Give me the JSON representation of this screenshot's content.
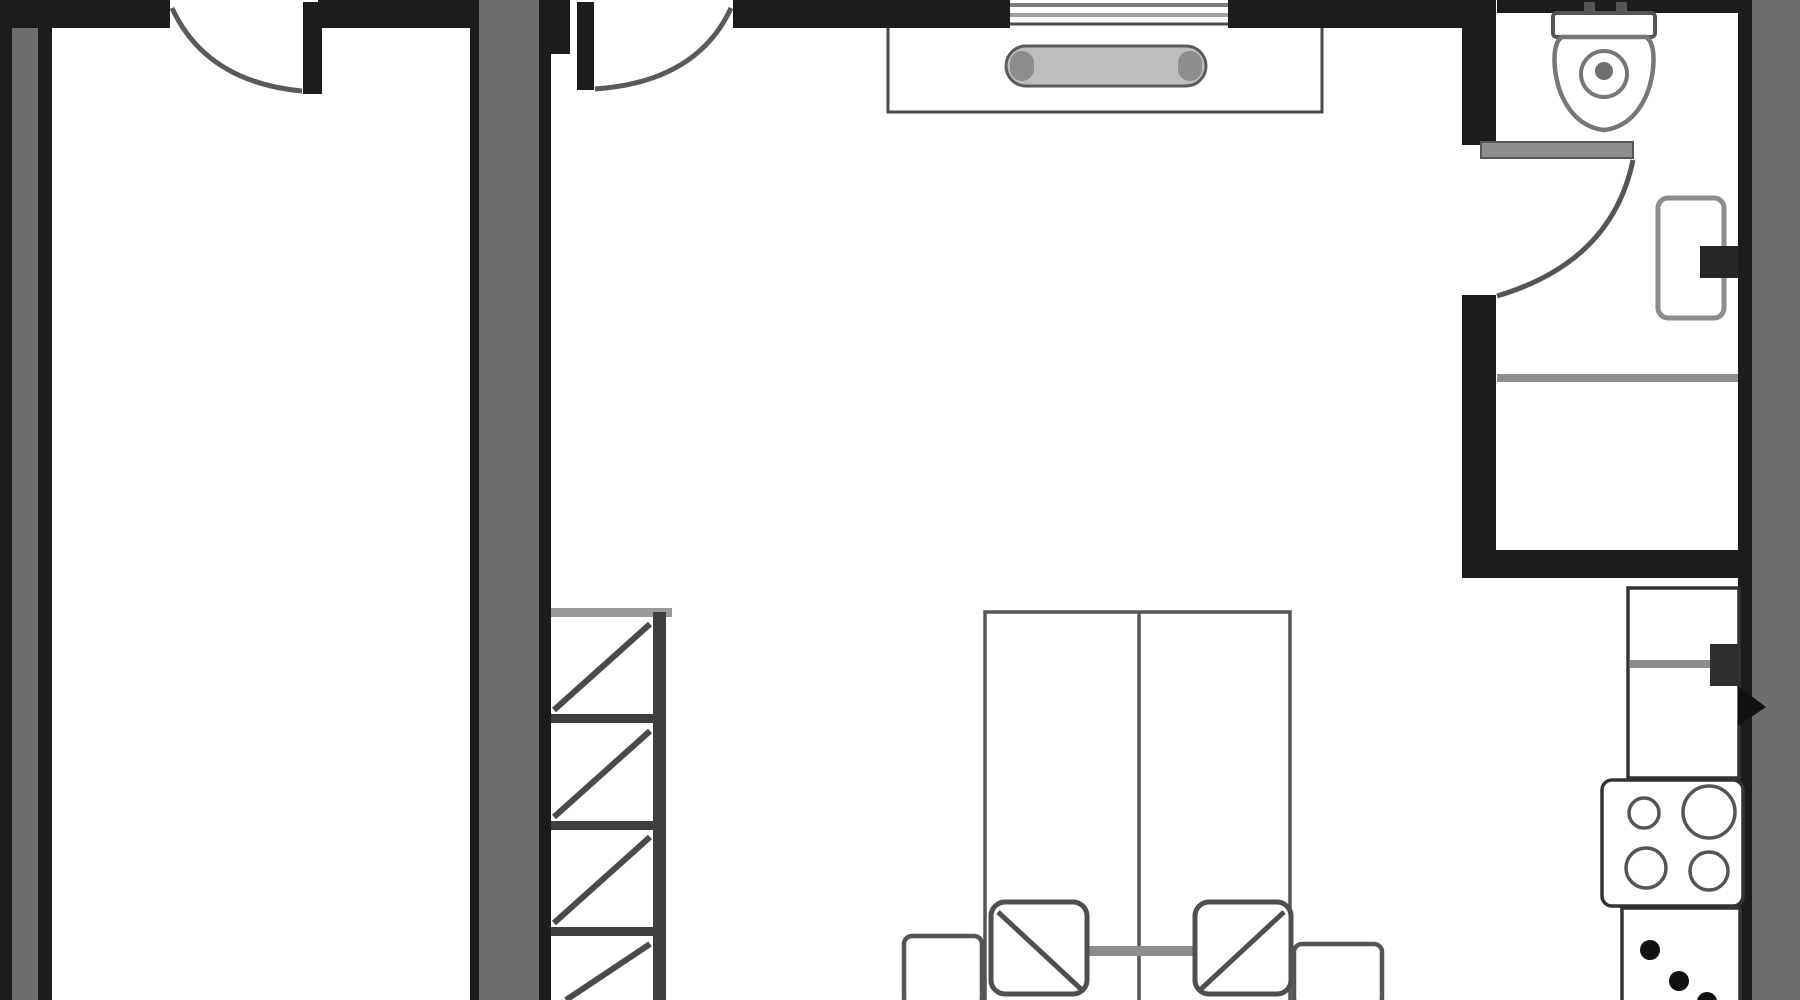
{
  "plan": {
    "canvas": {
      "width": 1800,
      "height": 1000,
      "background": "#ffffff"
    },
    "colors": {
      "wall_dark": "#1c1c1c",
      "wall_fill": "#6e6e6e",
      "outline_dark": "#333333",
      "outline_mid": "#555555",
      "outline_soft": "#7a7a7a",
      "fixture_gray": "#8d8d8d",
      "accent_black": "#111111",
      "floor_white": "#ffffff"
    },
    "shapes": [
      {
        "name": "dresser-body",
        "type": "rect",
        "x": 888,
        "y": 24,
        "w": 434,
        "h": 88,
        "fill": "#ffffff",
        "stroke": "#4a4a4a",
        "sw": 3
      },
      {
        "name": "dresser-handle",
        "type": "rect",
        "x": 1006,
        "y": 46,
        "w": 200,
        "h": 40,
        "rx": 20,
        "fill": "#bdbdbd",
        "stroke": "#5a5a5a",
        "sw": 3
      },
      {
        "name": "dresser-handle-cap-left",
        "type": "rect",
        "x": 1010,
        "y": 51,
        "w": 24,
        "h": 30,
        "rx": 12,
        "fill": "#8d8d8d"
      },
      {
        "name": "dresser-handle-cap-right",
        "type": "rect",
        "x": 1178,
        "y": 51,
        "w": 24,
        "h": 30,
        "rx": 12,
        "fill": "#8d8d8d"
      },
      {
        "name": "stairs-top-edge",
        "type": "rect",
        "x": 550,
        "y": 608,
        "w": 122,
        "h": 9,
        "fill": "#9a9a9a"
      },
      {
        "name": "stairs-tread-1",
        "type": "rect",
        "x": 550,
        "y": 714,
        "w": 106,
        "h": 9,
        "fill": "#3f3f3f"
      },
      {
        "name": "stairs-tread-2",
        "type": "rect",
        "x": 550,
        "y": 821,
        "w": 106,
        "h": 9,
        "fill": "#3f3f3f"
      },
      {
        "name": "stairs-tread-3",
        "type": "rect",
        "x": 550,
        "y": 927,
        "w": 106,
        "h": 9,
        "fill": "#3f3f3f"
      },
      {
        "name": "stairs-rail",
        "type": "rect",
        "x": 653,
        "y": 612,
        "w": 13,
        "h": 388,
        "fill": "#3f3f3f"
      },
      {
        "name": "stairs-diagonal-1",
        "type": "line",
        "x1": 554,
        "y1": 710,
        "x2": 650,
        "y2": 624,
        "stroke": "#4a4a4a",
        "sw": 6
      },
      {
        "name": "stairs-diagonal-2",
        "type": "line",
        "x1": 554,
        "y1": 817,
        "x2": 650,
        "y2": 731,
        "stroke": "#4a4a4a",
        "sw": 6
      },
      {
        "name": "stairs-diagonal-3",
        "type": "line",
        "x1": 554,
        "y1": 923,
        "x2": 650,
        "y2": 837,
        "stroke": "#4a4a4a",
        "sw": 6
      },
      {
        "name": "stairs-diagonal-4",
        "type": "line",
        "x1": 566,
        "y1": 1000,
        "x2": 650,
        "y2": 944,
        "stroke": "#4a4a4a",
        "sw": 6
      },
      {
        "name": "bed-frame",
        "type": "rect",
        "x": 985,
        "y": 612,
        "w": 305,
        "h": 392,
        "fill": "#ffffff",
        "stroke": "#565656",
        "sw": 3.5
      },
      {
        "name": "bed-center-line",
        "type": "line",
        "x1": 1139,
        "y1": 612,
        "x2": 1139,
        "y2": 1000,
        "stroke": "#565656",
        "sw": 3.5
      },
      {
        "name": "bed-blanket-band",
        "type": "rect",
        "x": 1085,
        "y": 946,
        "w": 113,
        "h": 10,
        "fill": "#8d8d8d"
      },
      {
        "name": "bed-blanket-flap-left",
        "type": "rect",
        "x": 991,
        "y": 902,
        "w": 96,
        "h": 92,
        "rx": 14,
        "fill": "#ffffff",
        "stroke": "#4f4f4f",
        "sw": 5
      },
      {
        "name": "bed-blanket-flap-left-fold",
        "type": "line",
        "x1": 998,
        "y1": 912,
        "x2": 1082,
        "y2": 990,
        "stroke": "#4f4f4f",
        "sw": 5
      },
      {
        "name": "bed-blanket-flap-right",
        "type": "rect",
        "x": 1195,
        "y": 902,
        "w": 96,
        "h": 92,
        "rx": 14,
        "fill": "#ffffff",
        "stroke": "#4f4f4f",
        "sw": 5
      },
      {
        "name": "bed-blanket-flap-right-fold",
        "type": "line",
        "x1": 1284,
        "y1": 912,
        "x2": 1200,
        "y2": 990,
        "stroke": "#4f4f4f",
        "sw": 5
      },
      {
        "name": "nightstand-left",
        "type": "rect",
        "x": 904,
        "y": 936,
        "w": 78,
        "h": 70,
        "rx": 8,
        "fill": "#ffffff",
        "stroke": "#555555",
        "sw": 4.5
      },
      {
        "name": "nightstand-right",
        "type": "rect",
        "x": 1294,
        "y": 944,
        "w": 88,
        "h": 62,
        "rx": 8,
        "fill": "#ffffff",
        "stroke": "#555555",
        "sw": 4.5
      },
      {
        "name": "left-wall-outer-edge",
        "type": "rect",
        "x": 0,
        "y": 0,
        "w": 12,
        "h": 1000,
        "fill": "#1c1c1c"
      },
      {
        "name": "left-wall-fill",
        "type": "rect",
        "x": 12,
        "y": 0,
        "w": 26,
        "h": 1000,
        "fill": "#6e6e6e"
      },
      {
        "name": "left-wall-inner-edge",
        "type": "rect",
        "x": 38,
        "y": 0,
        "w": 14,
        "h": 1000,
        "fill": "#1c1c1c"
      },
      {
        "name": "top-wall-segment-1",
        "type": "rect",
        "x": 0,
        "y": 0,
        "w": 170,
        "h": 28,
        "fill": "#1c1c1c"
      },
      {
        "name": "top-wall-segment-2",
        "type": "rect",
        "x": 318,
        "y": 0,
        "w": 152,
        "h": 28,
        "fill": "#1c1c1c"
      },
      {
        "name": "center-wall-left-edge",
        "type": "rect",
        "x": 470,
        "y": 0,
        "w": 9,
        "h": 1000,
        "fill": "#1c1c1c"
      },
      {
        "name": "center-wall-fill",
        "type": "rect",
        "x": 479,
        "y": 0,
        "w": 60,
        "h": 1000,
        "fill": "#6e6e6e"
      },
      {
        "name": "center-wall-right-edge",
        "type": "rect",
        "x": 539,
        "y": 0,
        "w": 12,
        "h": 1000,
        "fill": "#1c1c1c"
      },
      {
        "name": "center-door-jamb",
        "type": "rect",
        "x": 551,
        "y": 0,
        "w": 19,
        "h": 54,
        "fill": "#1c1c1c"
      },
      {
        "name": "top-wall-segment-3",
        "type": "rect",
        "x": 733,
        "y": 0,
        "w": 277,
        "h": 28,
        "fill": "#1c1c1c"
      },
      {
        "name": "top-wall-segment-4",
        "type": "rect",
        "x": 1228,
        "y": 0,
        "w": 234,
        "h": 28,
        "fill": "#1c1c1c"
      },
      {
        "name": "bathroom-top-wall",
        "type": "rect",
        "x": 1497,
        "y": 0,
        "w": 303,
        "h": 13,
        "fill": "#1c1c1c"
      },
      {
        "name": "bathroom-wall-upper-left",
        "type": "rect",
        "x": 1462,
        "y": 0,
        "w": 34,
        "h": 145,
        "fill": "#1c1c1c"
      },
      {
        "name": "bathroom-wall-lower-left",
        "type": "rect",
        "x": 1462,
        "y": 295,
        "w": 34,
        "h": 283,
        "fill": "#1c1c1c"
      },
      {
        "name": "bathroom-bottom-wall",
        "type": "rect",
        "x": 1462,
        "y": 550,
        "w": 276,
        "h": 28,
        "fill": "#1c1c1c"
      },
      {
        "name": "right-wall-inner-edge",
        "type": "rect",
        "x": 1738,
        "y": 0,
        "w": 14,
        "h": 1000,
        "fill": "#1c1c1c"
      },
      {
        "name": "right-wall-fill",
        "type": "rect",
        "x": 1752,
        "y": 0,
        "w": 48,
        "h": 1000,
        "fill": "#6e6e6e"
      },
      {
        "name": "window-outer-line",
        "type": "rect",
        "x": 1010,
        "y": 3,
        "w": 218,
        "h": 4,
        "fill": "#7a7a7a"
      },
      {
        "name": "window-inner-line",
        "type": "rect",
        "x": 1010,
        "y": 13,
        "w": 218,
        "h": 4,
        "fill": "#9f9f9f"
      },
      {
        "name": "toilet-tank",
        "type": "rect",
        "x": 1553,
        "y": 13,
        "w": 102,
        "h": 24,
        "rx": 4,
        "fill": "#ffffff",
        "stroke": "#555555",
        "sw": 4
      },
      {
        "name": "toilet-hinge-left",
        "type": "rect",
        "x": 1584,
        "y": 2,
        "w": 11,
        "h": 11,
        "fill": "#555555"
      },
      {
        "name": "toilet-hinge-right",
        "type": "rect",
        "x": 1616,
        "y": 2,
        "w": 11,
        "h": 11,
        "fill": "#555555"
      },
      {
        "name": "toilet-bowl",
        "type": "path",
        "d": "M 1562 37 C 1551 43 1553 76 1562 96 C 1572 118 1587 128 1604 130 C 1621 128 1636 118 1646 96 C 1655 76 1657 43 1646 37 Z",
        "fill": "#ffffff",
        "stroke": "#777777",
        "sw": 4.5
      },
      {
        "name": "toilet-seat-ring",
        "type": "circle",
        "cx": 1604,
        "cy": 74,
        "r": 23,
        "fill": "#ffffff",
        "stroke": "#777777",
        "sw": 4
      },
      {
        "name": "toilet-flush-dot",
        "type": "circle",
        "cx": 1604,
        "cy": 71,
        "r": 9,
        "fill": "#6f6f6f"
      },
      {
        "name": "bath-sink-body",
        "type": "rect",
        "x": 1658,
        "y": 198,
        "w": 66,
        "h": 120,
        "rx": 10,
        "fill": "#ffffff",
        "stroke": "#8d8d8d",
        "sw": 5
      },
      {
        "name": "bath-sink-faucet",
        "type": "rect",
        "x": 1700,
        "y": 246,
        "w": 38,
        "h": 32,
        "fill": "#262626"
      },
      {
        "name": "bath-shelf-line",
        "type": "rect",
        "x": 1497,
        "y": 374,
        "w": 241,
        "h": 8,
        "fill": "#8d8d8d"
      },
      {
        "name": "kitchen-counter-upper",
        "type": "rect",
        "x": 1628,
        "y": 588,
        "w": 111,
        "h": 190,
        "fill": "#ffffff",
        "stroke": "#333333",
        "sw": 3.5
      },
      {
        "name": "kitchen-counter-divider",
        "type": "rect",
        "x": 1630,
        "y": 660,
        "w": 82,
        "h": 8,
        "fill": "#8d8d8d"
      },
      {
        "name": "kitchen-counter-handle",
        "type": "rect",
        "x": 1710,
        "y": 644,
        "w": 28,
        "h": 42,
        "fill": "#2e2e2e"
      },
      {
        "name": "kitchen-wall-handle-arrow",
        "type": "polygon",
        "points": "1738,686 1766,707 1738,726",
        "fill": "#111111"
      },
      {
        "name": "stove-body",
        "type": "rect",
        "x": 1602,
        "y": 780,
        "w": 141,
        "h": 126,
        "rx": 10,
        "fill": "#ffffff",
        "stroke": "#333333",
        "sw": 3.5
      },
      {
        "name": "stove-burner-top-left",
        "type": "circle",
        "cx": 1644,
        "cy": 813,
        "r": 15,
        "fill": "#ffffff",
        "stroke": "#555555",
        "sw": 3.5
      },
      {
        "name": "stove-burner-top-right",
        "type": "circle",
        "cx": 1709,
        "cy": 812,
        "r": 26,
        "fill": "#ffffff",
        "stroke": "#555555",
        "sw": 3.5
      },
      {
        "name": "stove-burner-bottom-left",
        "type": "circle",
        "cx": 1646,
        "cy": 868,
        "r": 20,
        "fill": "#ffffff",
        "stroke": "#555555",
        "sw": 3.5
      },
      {
        "name": "stove-burner-bottom-right",
        "type": "circle",
        "cx": 1709,
        "cy": 871,
        "r": 19,
        "fill": "#ffffff",
        "stroke": "#555555",
        "sw": 3.5
      },
      {
        "name": "kitchen-counter-lower",
        "type": "rect",
        "x": 1622,
        "y": 908,
        "w": 118,
        "h": 96,
        "fill": "#ffffff",
        "stroke": "#333333",
        "sw": 3.5
      },
      {
        "name": "sink-dot-1",
        "type": "circle",
        "cx": 1650,
        "cy": 950,
        "r": 10,
        "fill": "#111111"
      },
      {
        "name": "sink-dot-2",
        "type": "circle",
        "cx": 1679,
        "cy": 981,
        "r": 10,
        "fill": "#111111"
      },
      {
        "name": "sink-dot-3",
        "type": "circle",
        "cx": 1707,
        "cy": 1002,
        "r": 10,
        "fill": "#111111"
      },
      {
        "name": "door-left-leaf",
        "type": "rect",
        "x": 303,
        "y": 2,
        "w": 19,
        "h": 92,
        "fill": "#1c1c1c"
      },
      {
        "name": "door-left-swing-arc",
        "type": "path",
        "d": "M 172 8 Q 206 82 302 91",
        "fill": "none",
        "stroke": "#5a5a5a",
        "sw": 5
      },
      {
        "name": "door-center-leaf",
        "type": "rect",
        "x": 577,
        "y": 2,
        "w": 17,
        "h": 88,
        "fill": "#1c1c1c"
      },
      {
        "name": "door-center-swing-arc",
        "type": "path",
        "d": "M 731 8 Q 697 82 595 89",
        "fill": "none",
        "stroke": "#5a5a5a",
        "sw": 5
      },
      {
        "name": "bathroom-door-leaf",
        "type": "rect",
        "x": 1481,
        "y": 142,
        "w": 152,
        "h": 16,
        "fill": "#8d8d8d",
        "stroke": "#555555",
        "sw": 2
      },
      {
        "name": "bathroom-door-swing-arc",
        "type": "path",
        "d": "M 1633 160 Q 1612 262 1497 296",
        "fill": "none",
        "stroke": "#555555",
        "sw": 5
      }
    ]
  }
}
